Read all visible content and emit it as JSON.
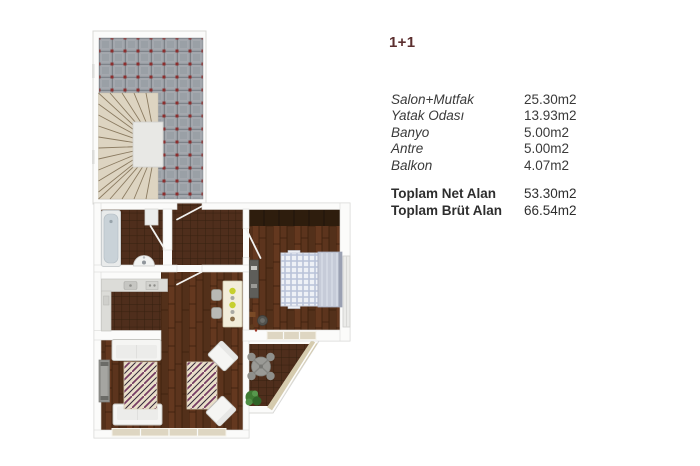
{
  "window": {
    "width": 700,
    "height": 466,
    "background": "#ffffff"
  },
  "panel": {
    "title": "1+1",
    "title_color": "#5c2f2f",
    "rows": [
      {
        "label": "Salon+Mutfak",
        "value": "25.30m2"
      },
      {
        "label": "Yatak Odası",
        "value": "13.93m2"
      },
      {
        "label": "Banyo",
        "value": "5.00m2"
      },
      {
        "label": "Antre",
        "value": "5.00m2"
      },
      {
        "label": "Balkon",
        "value": "4.07m2"
      }
    ],
    "totals": [
      {
        "label": "Toplam Net Alan",
        "value": "53.30m2"
      },
      {
        "label": "Toplam Brüt Alan",
        "value": "66.54m2"
      }
    ]
  },
  "floorplan": {
    "colors": {
      "wall": "#fbfbfa",
      "wall_edge": "#d8d8d6",
      "terrace_tile": "#9aa0a6",
      "terrace_grout": "#6f747b",
      "terrace_dot_red": "#8c2e2e",
      "stairs": "#ddd4c1",
      "stair_line": "#8b7b61",
      "dark_tile": "#4f2e1c",
      "dark_tile_grout": "#35200f",
      "wood": "#5c341d",
      "wood_line": "#3a1e0c",
      "wardrobe": "#2e1d0d",
      "window_beige": "#ded6c2",
      "balcony_rail": "#d5cbae",
      "furniture_white": "#f5f5f3",
      "bathtub_inner": "#c9d2d8",
      "bed_plaid_line": "#b9c3d8",
      "bed_headboard": "#c6cbd8",
      "rug_base": "#e9dec9",
      "rug_purple": "#743a62",
      "plate_yellow": "#c6cf2e",
      "table_gray": "#9a9a96",
      "plant_green": "#3f7b33"
    }
  }
}
